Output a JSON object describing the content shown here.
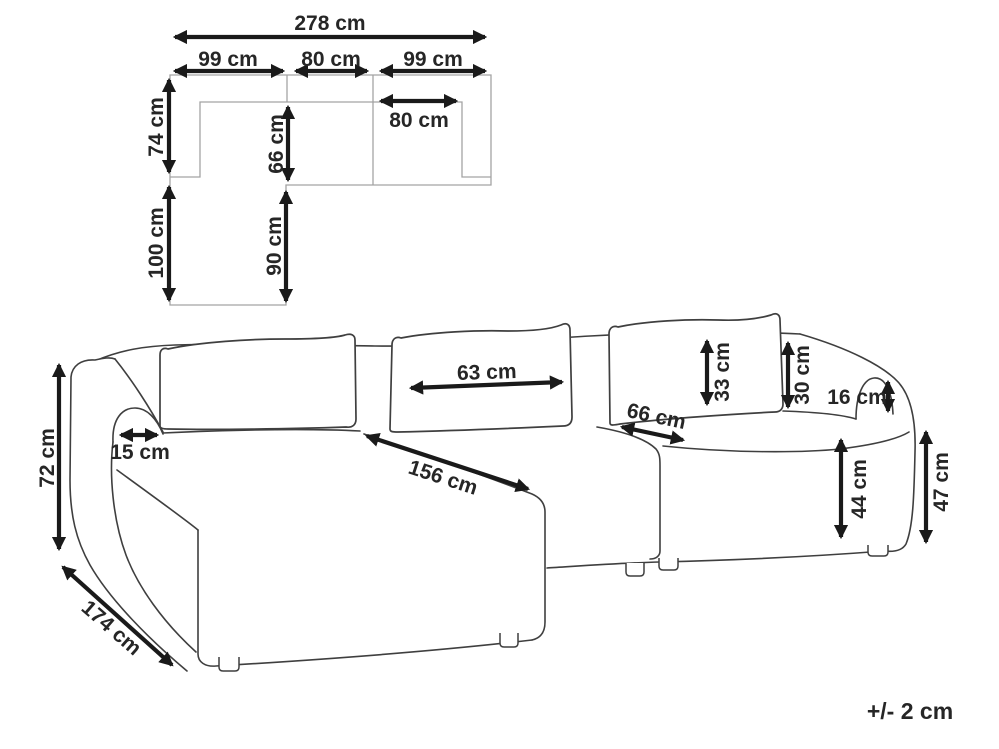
{
  "top_view": {
    "total_width": "278 cm",
    "section_widths": [
      "99 cm",
      "80 cm",
      "99 cm"
    ],
    "right_seat_width": "80 cm",
    "total_depth": "74 cm",
    "seat_depth": "66 cm",
    "chaise_extension": "100 cm",
    "chaise_depth": "90 cm"
  },
  "front_view": {
    "total_height": "72 cm",
    "armrest_width": "15 cm",
    "chaise_total_depth": "174 cm",
    "chaise_length": "156 cm",
    "cushion_width": "63 cm",
    "seat_depth": "66 cm",
    "cushion_height": "33 cm",
    "backrest_height": "30 cm",
    "armrest_above_seat": "16 cm",
    "seat_height": "44 cm",
    "armrest_height": "47 cm"
  },
  "tolerance": "+/- 2 cm"
}
